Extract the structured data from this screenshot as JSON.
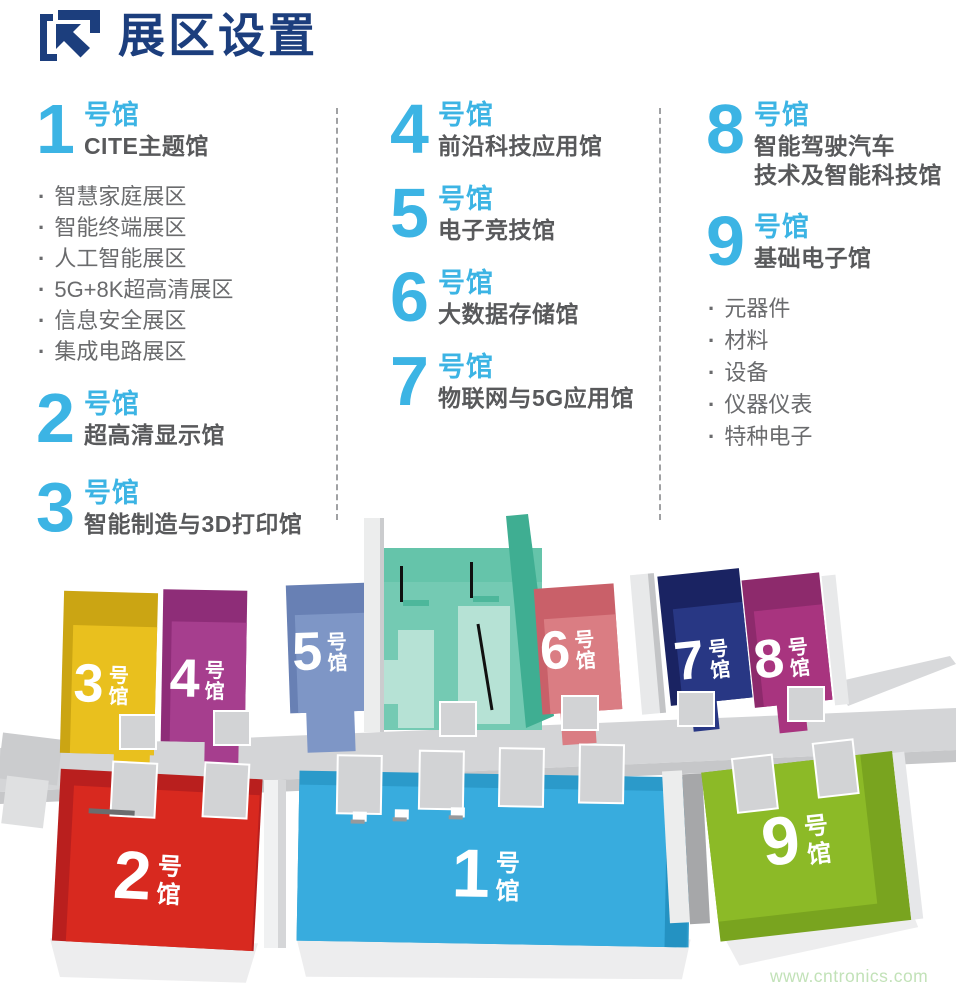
{
  "header": {
    "title": "展区设置",
    "logo_icon": "arrow-up-left-bracket-icon"
  },
  "colors": {
    "accent_cyan": "#3cb4e4",
    "title_navy": "#1c3e7d",
    "subtitle_gray": "#58595b",
    "bullet_gray": "#6a6b6d",
    "watermark_green": "#c2e2b8"
  },
  "columns": [
    {
      "halls": [
        {
          "num": "1",
          "suffix": "号馆",
          "name": "CITE主题馆",
          "bullets": [
            "智慧家庭展区",
            "智能终端展区",
            "人工智能展区",
            "5G+8K超高清展区",
            "信息安全展区",
            "集成电路展区"
          ]
        },
        {
          "num": "2",
          "suffix": "号馆",
          "name": "超高清显示馆"
        },
        {
          "num": "3",
          "suffix": "号馆",
          "name": "智能制造与3D打印馆"
        }
      ]
    },
    {
      "halls": [
        {
          "num": "4",
          "suffix": "号馆",
          "name": "前沿科技应用馆"
        },
        {
          "num": "5",
          "suffix": "号馆",
          "name": "电子竞技馆"
        },
        {
          "num": "6",
          "suffix": "号馆",
          "name": "大数据存储馆"
        },
        {
          "num": "7",
          "suffix": "号馆",
          "name": "物联网与5G应用馆"
        }
      ]
    },
    {
      "halls": [
        {
          "num": "8",
          "suffix": "号馆",
          "name_line1": "智能驾驶汽车",
          "name_line2": "技术及智能科技馆"
        },
        {
          "num": "9",
          "suffix": "号馆",
          "name": "基础电子馆",
          "bullets": [
            "元器件",
            "材料",
            "设备",
            "仪器仪表",
            "特种电子"
          ]
        }
      ]
    }
  ],
  "map": {
    "suffix": [
      "号",
      "馆"
    ],
    "center_hall_color": "#74cab3",
    "halls": [
      {
        "num": "3",
        "color": "#e9c01e",
        "roof": "#cba513"
      },
      {
        "num": "4",
        "color": "#a63e8e",
        "roof": "#8e2d78"
      },
      {
        "num": "5",
        "color": "#7e96c6",
        "roof": "#6880b4"
      },
      {
        "num": "6",
        "color": "#da7d83",
        "roof": "#c96069"
      },
      {
        "num": "7",
        "color": "#283784",
        "roof": "#1a2362"
      },
      {
        "num": "8",
        "color": "#a8347f",
        "roof": "#8d2a6c"
      },
      {
        "num": "2",
        "color": "#d8291f",
        "roof": "#b91f1e"
      },
      {
        "num": "1",
        "color": "#38acde",
        "roof": "#2b9aca"
      },
      {
        "num": "9",
        "color": "#8cba27",
        "roof": "#79a41f"
      }
    ]
  },
  "watermark": "www.cntronics.com"
}
